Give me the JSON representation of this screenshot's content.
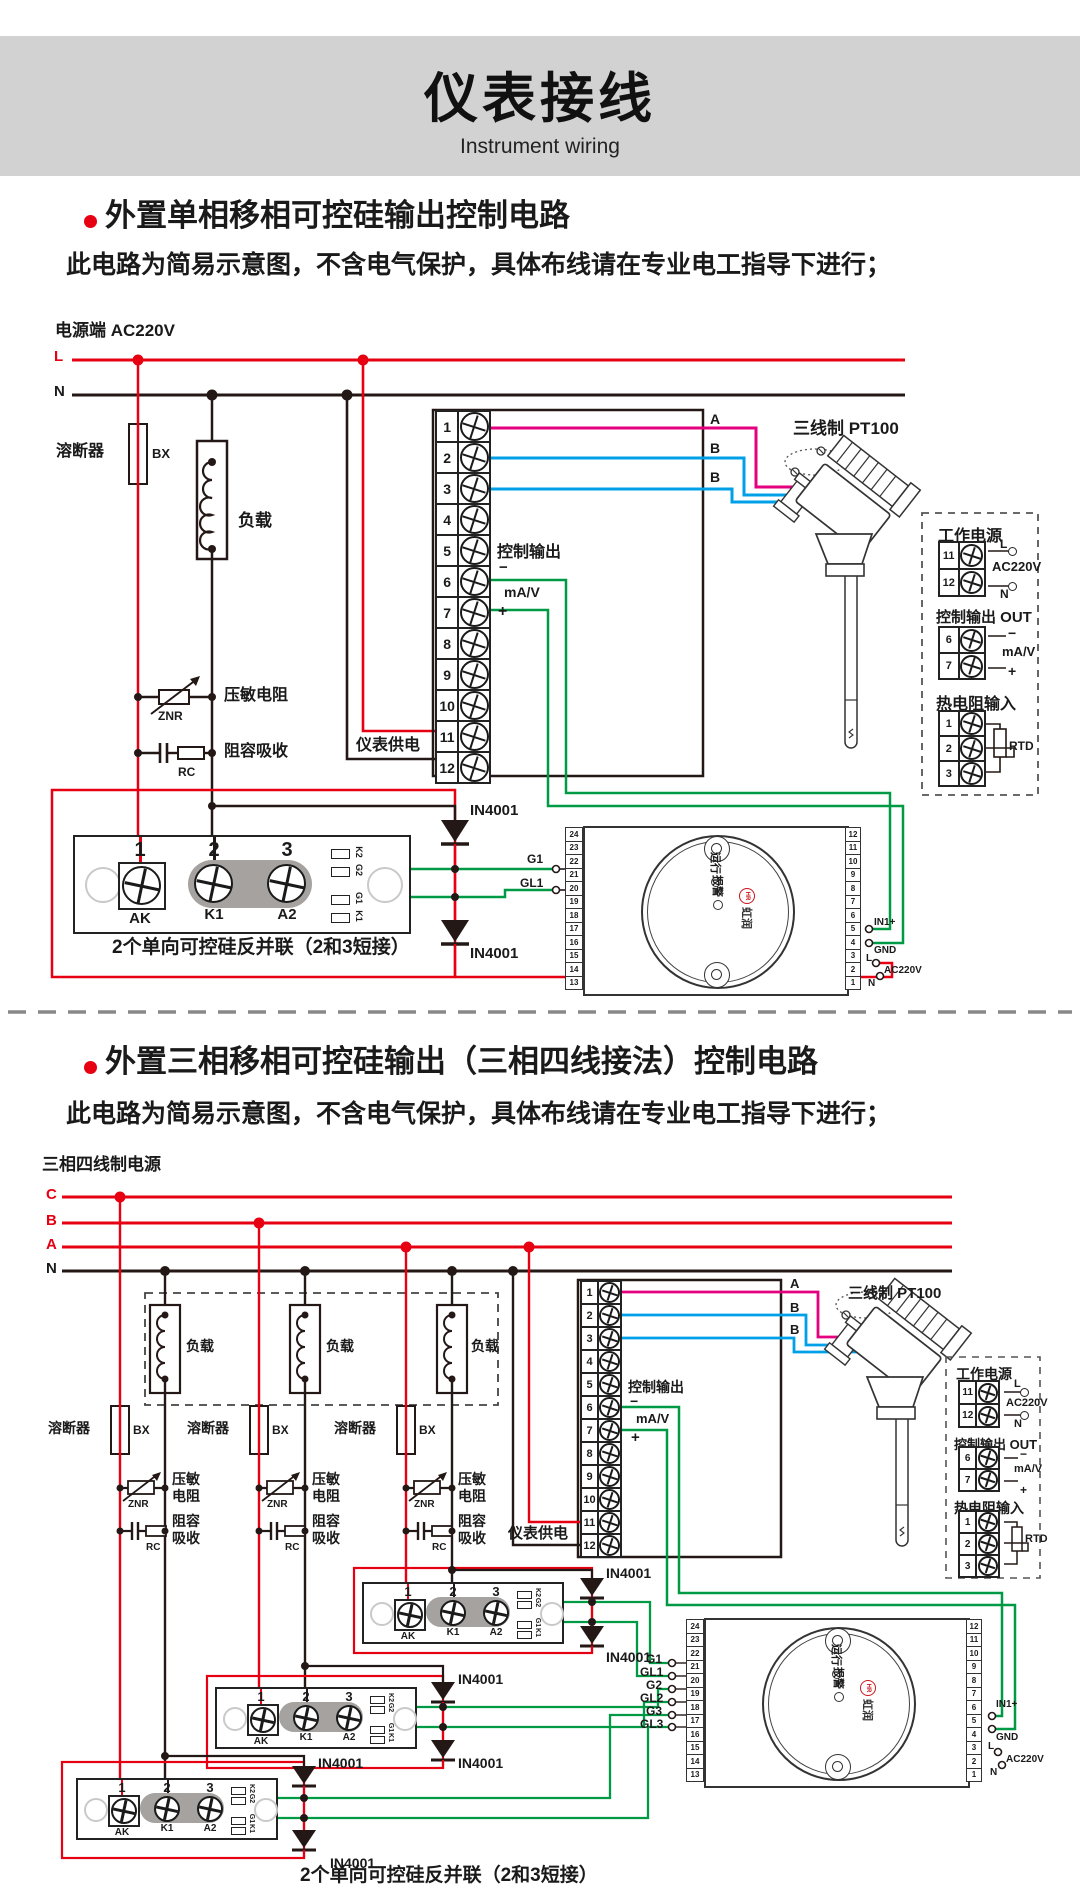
{
  "header": {
    "title": "仪表接线",
    "subtitle": "Instrument wiring"
  },
  "section1": {
    "bullet_title": "外置单相移相可控硅输出控制电路",
    "power_label": "电源端  AC220V",
    "l": "L",
    "n": "N"
  },
  "section2": {
    "bullet_title": "外置三相移相可控硅输出（三相四线接法）控制电路",
    "power_label": "三相四线制电源",
    "c": "C",
    "b": "B",
    "a": "A",
    "n": "N"
  },
  "common": {
    "note": "此电路为简易示意图，不含电气保护，具体布线请在专业电工指导下进行；",
    "fuse": "溶断器",
    "fuse_code": "BX",
    "load": "负载",
    "varistor": "压敏电阻",
    "varistor_l1": "压敏",
    "varistor_l2": "电阻",
    "varistor_code": "ZNR",
    "snubber": "阻容吸收",
    "snubber_l1": "阻容",
    "snubber_l2": "吸收",
    "snubber_code": "RC",
    "meter_supply": "仪表供电",
    "ctrl_out": "控制输出",
    "ctrl_unit": "mA/V",
    "minus": "−",
    "plus": "+",
    "sensor": "三线制 PT100",
    "wire_a": "A",
    "wire_b": "B",
    "diode": "IN4001",
    "scr_caption": "2个单向可控硅反并联（2和3短接）",
    "inst_terminals": [
      "1",
      "2",
      "3",
      "4",
      "5",
      "6",
      "7",
      "8",
      "9",
      "10",
      "11",
      "12"
    ],
    "panel": {
      "power_title": "工作电源",
      "power_rows": [
        "11",
        "12"
      ],
      "l": "L",
      "n": "N",
      "voltage": "AC220V",
      "out_title": "控制输出 OUT",
      "out_rows": [
        "6",
        "7"
      ],
      "minus": "−",
      "plus": "+",
      "unit": "mA/V",
      "rtd_title": "热电阻输入",
      "rtd_rows": [
        "1",
        "2",
        "3"
      ],
      "rtd": "RTD"
    },
    "scr": {
      "nums": [
        "1",
        "2",
        "3"
      ],
      "names": [
        "AK",
        "K1",
        "A2"
      ],
      "side": [
        "K2",
        "G2",
        "G1",
        "K1"
      ]
    },
    "device": {
      "left_terminals": [
        "24",
        "23",
        "22",
        "21",
        "20",
        "19",
        "18",
        "17",
        "16",
        "15",
        "14",
        "13"
      ],
      "right_terminals": [
        "12",
        "11",
        "10",
        "9",
        "8",
        "7",
        "6",
        "5",
        "4",
        "3",
        "2",
        "1"
      ],
      "run": "运行",
      "alarm": "报警",
      "brand": "虹润",
      "brand_mark": "HR",
      "in1": "IN1+",
      "gnd": "GND",
      "l": "L",
      "n": "N",
      "voltage": "AC220V"
    },
    "gates": {
      "g1": "G1",
      "gl1": "GL1",
      "g2": "G2",
      "gl2": "GL2",
      "g3": "G3",
      "gl3": "GL3"
    }
  }
}
